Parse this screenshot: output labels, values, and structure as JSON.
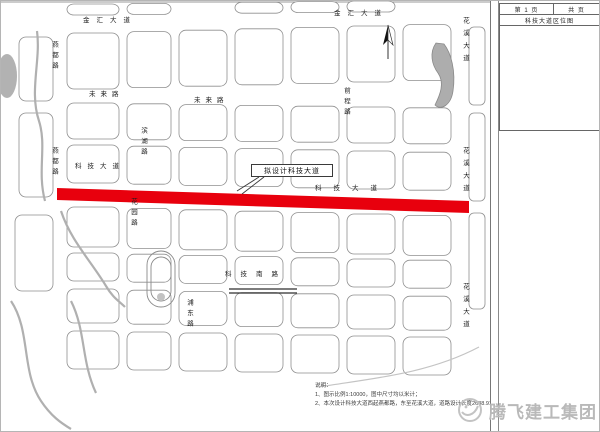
{
  "sheet": {
    "title_block": {
      "page": "第 1 页",
      "total": "共  页",
      "drawing_title": "科技大道区位图"
    },
    "watermark": "腾飞建工集团"
  },
  "map": {
    "road_color": "#e8000d",
    "water_color": "#b0b0b0",
    "callout": "拟设计科技大道",
    "street_labels": [
      {
        "text": "金汇大道",
        "x": 82,
        "y": 17,
        "orient": "h",
        "ls": 7
      },
      {
        "text": "金汇大道",
        "x": 333,
        "y": 10,
        "orient": "h",
        "ls": 7
      },
      {
        "text": "未来路",
        "x": 88,
        "y": 91,
        "orient": "h",
        "ls": 5
      },
      {
        "text": "未来路",
        "x": 193,
        "y": 97,
        "orient": "h",
        "ls": 5
      },
      {
        "text": "科技大道",
        "x": 74,
        "y": 163,
        "orient": "h",
        "ls": 6
      },
      {
        "text": "科技大道",
        "x": 314,
        "y": 185,
        "orient": "h",
        "ls": 12
      },
      {
        "text": "科技南路",
        "x": 224,
        "y": 271,
        "orient": "h",
        "ls": 9
      },
      {
        "text": "花溪大道",
        "x": 460,
        "y": 16,
        "orient": "v",
        "ls": 6
      },
      {
        "text": "花溪大道",
        "x": 460,
        "y": 146,
        "orient": "v",
        "ls": 6
      },
      {
        "text": "花溪大道",
        "x": 460,
        "y": 282,
        "orient": "v",
        "ls": 6
      },
      {
        "text": "燕都路",
        "x": 49,
        "y": 40,
        "orient": "v",
        "ls": 4
      },
      {
        "text": "燕都路",
        "x": 49,
        "y": 146,
        "orient": "v",
        "ls": 4
      },
      {
        "text": "滨湖路",
        "x": 138,
        "y": 126,
        "orient": "v",
        "ls": 4
      },
      {
        "text": "花园路",
        "x": 128,
        "y": 197,
        "orient": "v",
        "ls": 4
      },
      {
        "text": "前程路",
        "x": 341,
        "y": 86,
        "orient": "v",
        "ls": 4
      },
      {
        "text": "浦东路",
        "x": 184,
        "y": 298,
        "orient": "v",
        "ls": 4
      }
    ],
    "notes": {
      "heading": "说明：",
      "lines": [
        "1、图示比例1:10000，图中尺寸均以米计；",
        "2、本次设计科技大道西起燕都路，东至花溪大道，道路设计长度2638.91m。"
      ]
    }
  }
}
